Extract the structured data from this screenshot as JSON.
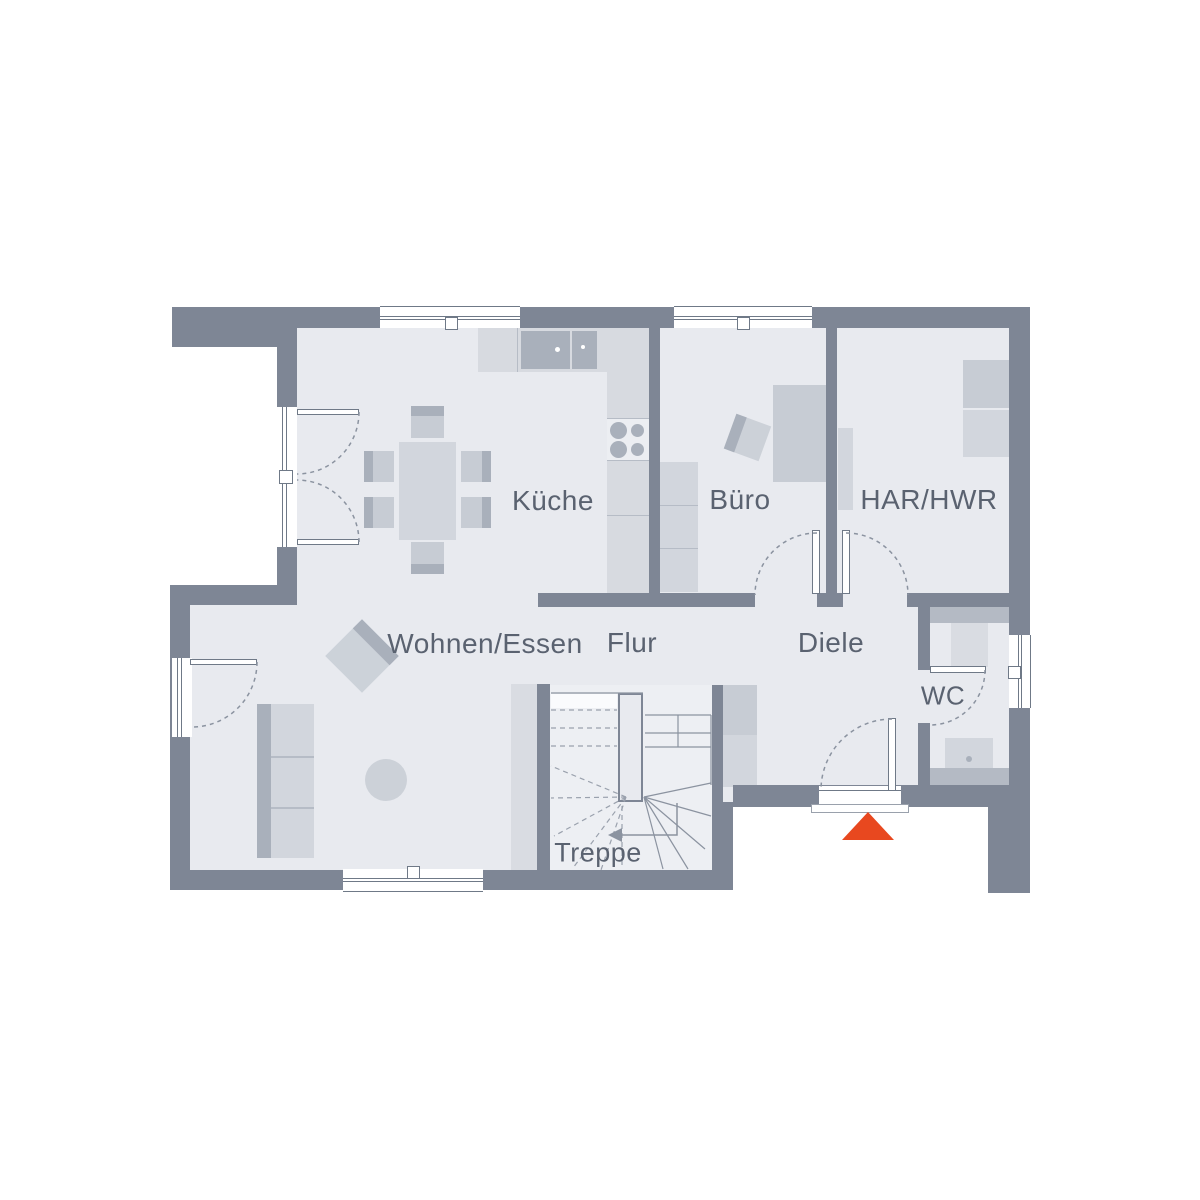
{
  "drawing": {
    "type": "floor-plan",
    "labels": {
      "kueche": "Küche",
      "buero": "Büro",
      "har_hwr": "HAR/HWR",
      "wohnen_essen": "Wohnen/Essen",
      "flur": "Flur",
      "diele": "Diele",
      "wc": "WC",
      "treppe": "Treppe"
    },
    "entrance_marker": {
      "shape": "triangle-up",
      "color": "#e8481f"
    },
    "colors": {
      "wall": "#7e8695",
      "floor": "#e8eaef",
      "furniture_light": "#d2d6dd",
      "furniture_medium": "#c7ccd4",
      "furniture_dark": "#a9b0bb",
      "label_text": "#5a6270",
      "line": "#8b93a0",
      "background": "#ffffff"
    }
  }
}
